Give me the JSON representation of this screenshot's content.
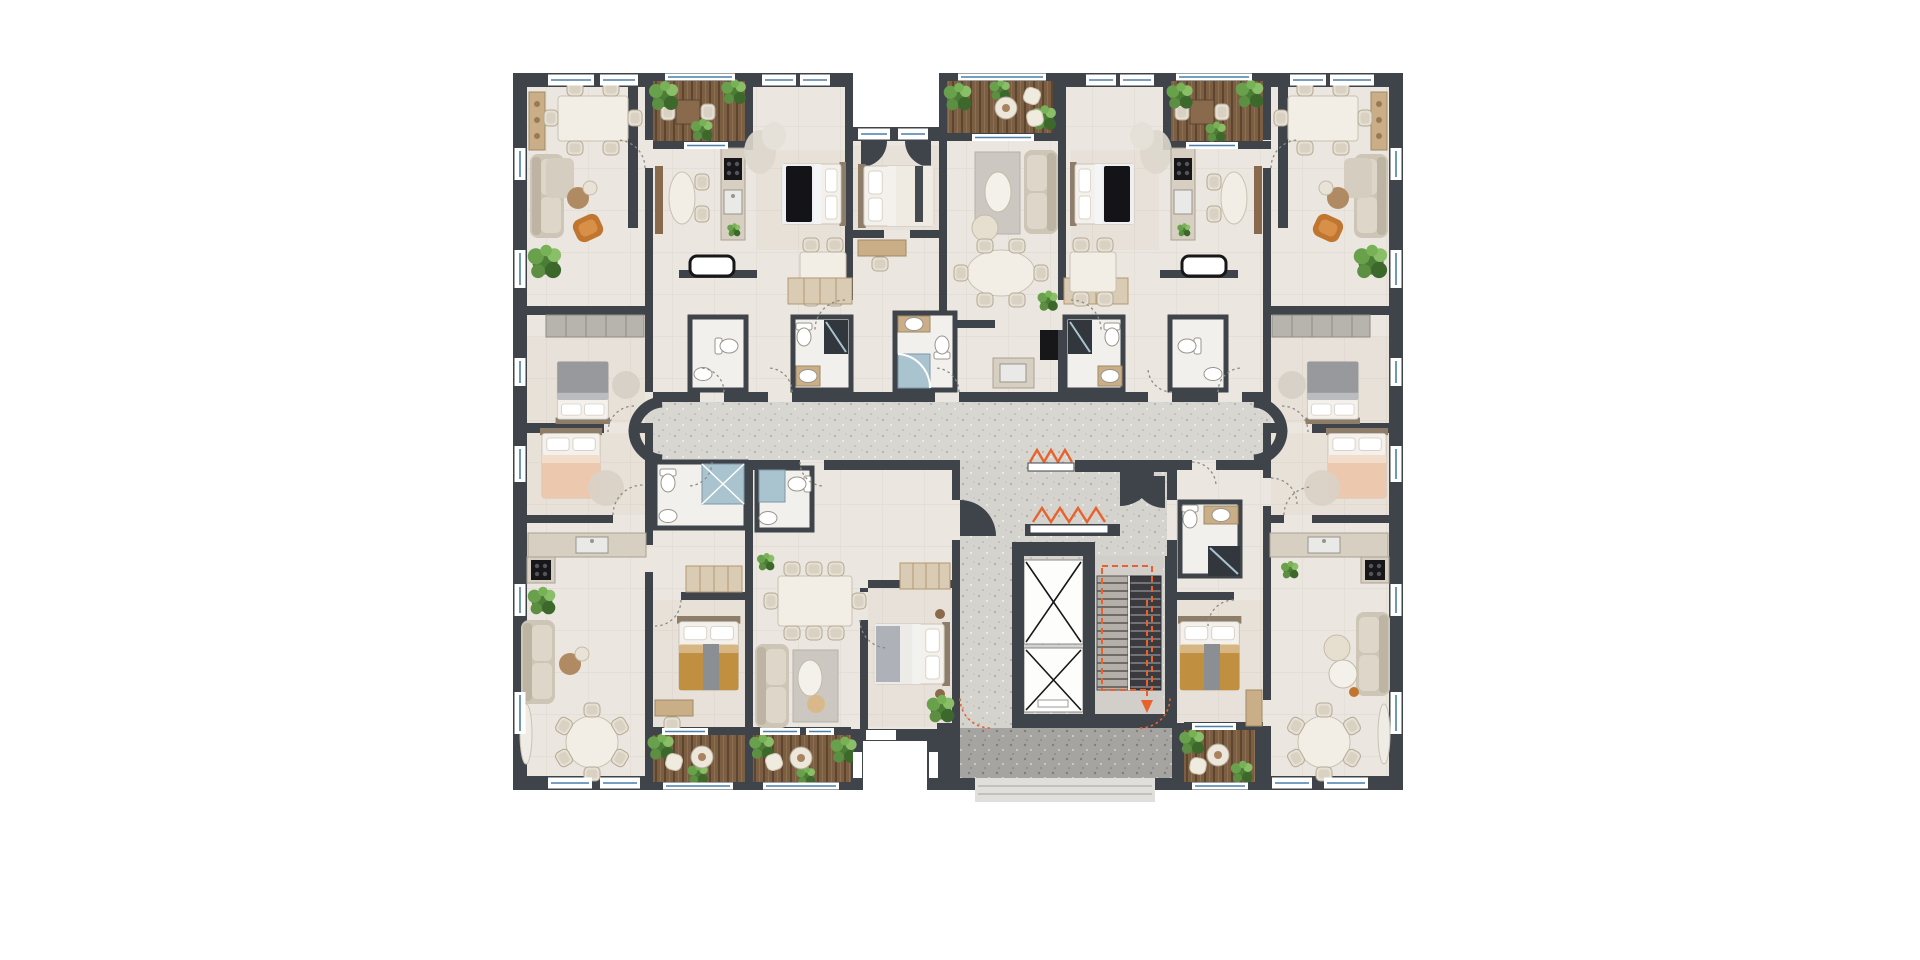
{
  "palette": {
    "background": "#ffffff",
    "wall": "#3f444a",
    "wall_soft": "#5a6066",
    "apartment_floor": "#ebe6df",
    "bedroom_tint": "#dcc8b8",
    "corridor_floor": "#d8d6d1",
    "lobby_floor": "#d5d3ce",
    "terrace_floor": "#a6a4a0",
    "entrance_floor": "#e0dfdb",
    "deck_wood": "#7c5e42",
    "deck_wood_dark": "#5d4530",
    "plant_green": "#4c7d36",
    "plant_green_light": "#8abf68",
    "window_glass": "#4a7fa8",
    "shower_glass": "#a9c3cf",
    "shower_dark": "#31373d",
    "fixture_white": "#ffffff",
    "furniture_beige": "#cdc5b6",
    "furniture_cream": "#efe9de",
    "furniture_tan": "#c9ae88",
    "cabinet_gray": "#b7b4ae",
    "marble": "#f2eee6",
    "wood_brown": "#8a6a4c",
    "accent_orange": "#c0762f",
    "accent_mustard": "#c08f3f",
    "accent_peach": "#ecc9ae",
    "bed_gray": "#97999d",
    "blanket_black": "#141418",
    "appliance_black": "#17171a",
    "escape_route": "#e8622d"
  },
  "building": {
    "elevator_count": 2,
    "stair_flight_count": 2,
    "balcony_count": 6
  },
  "icons": {
    "elevator-icon": "box-with-diagonal-cross",
    "stairs-icon": "striped-treads",
    "plant-icon": "green-circle-cluster",
    "bed-icon": "mattress-with-two-pillows",
    "sofa-icon": "backed-seat-with-cushions",
    "dining-table-icon": "table-surrounded-by-chairs",
    "toilet-icon": "oval-bowl-with-tank",
    "sink-icon": "white-oval-basin",
    "shower-icon": "glass-box",
    "door-swing-icon": "dashed-quarter-arc",
    "door-leaf-icon": "black-quarter-wedge",
    "window-icon": "white-sill-with-blue-glass-line",
    "escape-zigzag-icon": "orange-zigzag-gate",
    "escape-arrow-icon": "orange-dashed-path-with-arrow"
  }
}
